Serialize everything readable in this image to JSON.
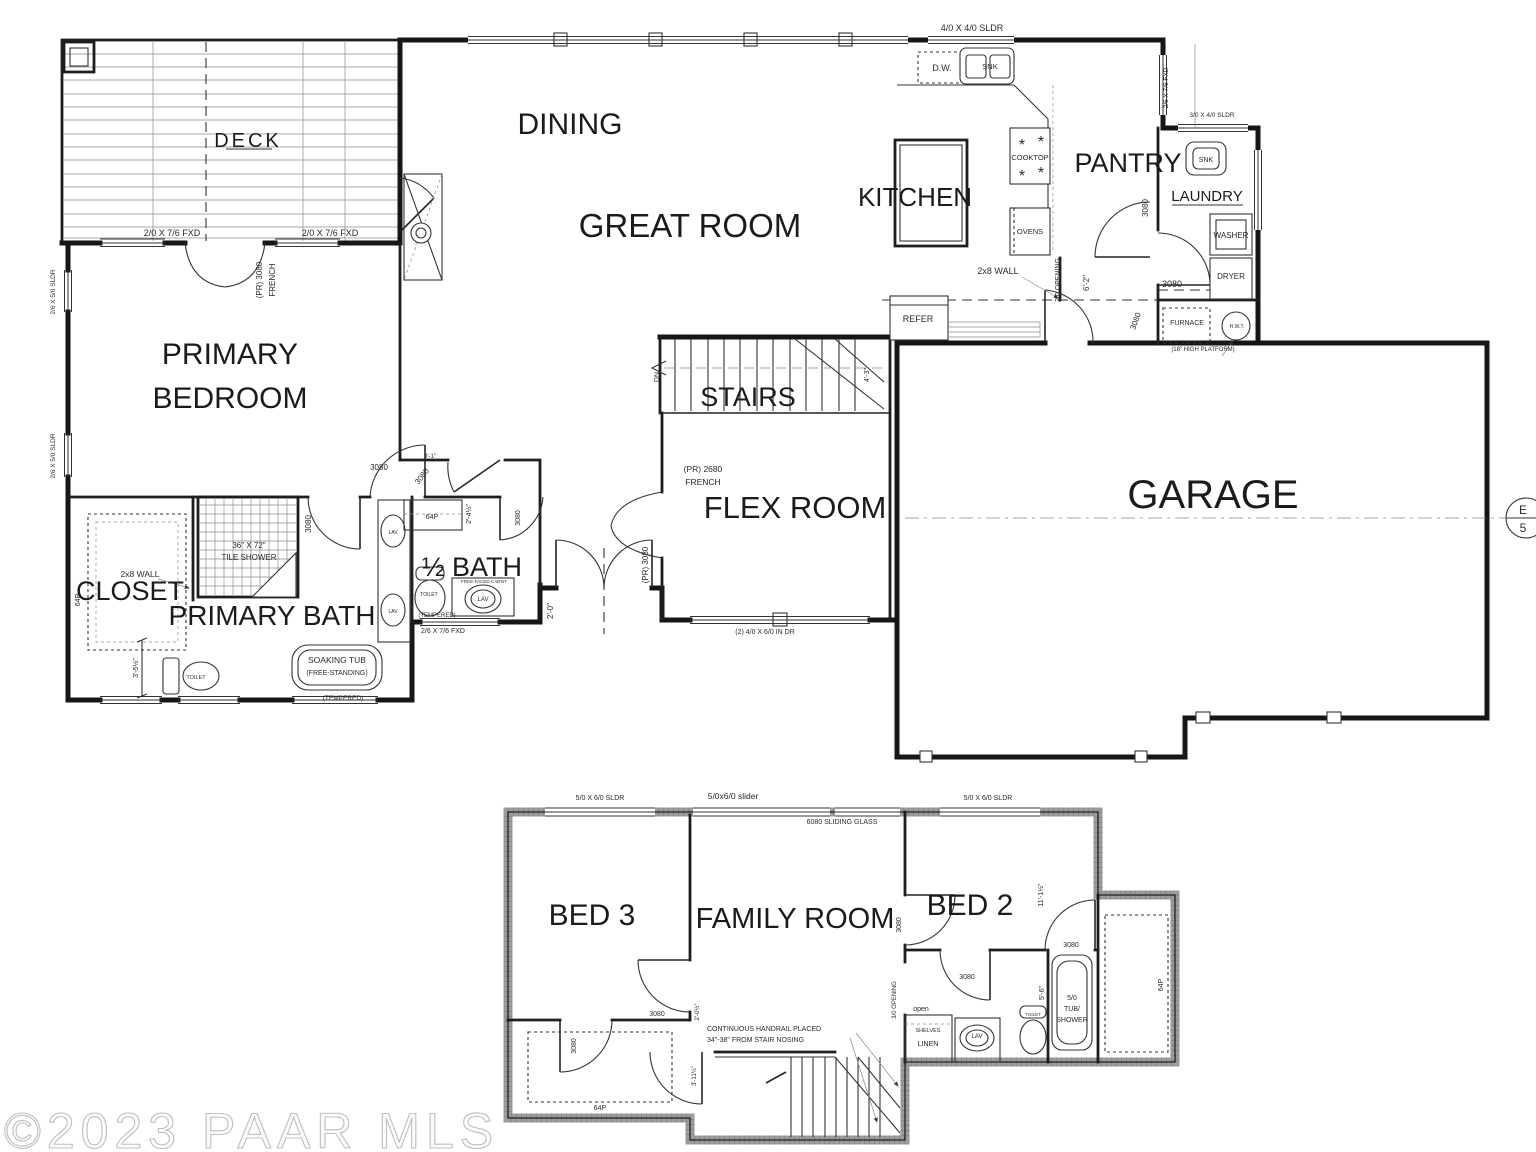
{
  "watermark": {
    "text": "©2023 PAAR MLS"
  },
  "colors": {
    "line": "#161616",
    "annotation": "#333333",
    "concrete": "#9b9b9b",
    "watermark": "#c8c8c8",
    "faded": "#8f8f8f"
  },
  "main_floor": {
    "rooms": {
      "deck": "DECK",
      "dining": "DINING",
      "great_room": "GREAT ROOM",
      "kitchen": "KITCHEN",
      "pantry": "PANTRY",
      "laundry": "LAUNDRY",
      "primary_line1": "PRIMARY",
      "primary_line2": "BEDROOM",
      "stairs": "STAIRS",
      "flex_room": "FLEX ROOM",
      "garage": "GARAGE",
      "closet": "CLOSET",
      "primary_bath": "PRIMARY BATH",
      "half_bath": "½ BATH"
    },
    "annotations": [
      {
        "t": "2/0 X 7/6 FXD",
        "x": 172,
        "y": 236,
        "s": 9
      },
      {
        "t": "2/0 X 7/6 FXD",
        "x": 330,
        "y": 236,
        "s": 9
      },
      {
        "t": "(PR) 3080",
        "x": 262,
        "y": 280,
        "s": 8,
        "r": -90
      },
      {
        "t": "FRENCH",
        "x": 275,
        "y": 280,
        "s": 8,
        "r": -90
      },
      {
        "t": "2/6 X 5/0 SLDR",
        "x": 55,
        "y": 292,
        "s": 6.5,
        "r": -90
      },
      {
        "t": "2/6 X 5/0 SLDR",
        "x": 55,
        "y": 456,
        "s": 6.5,
        "r": -90
      },
      {
        "t": "4/0 X 4/0 SLDR",
        "x": 972,
        "y": 31,
        "s": 9
      },
      {
        "t": "D.W.",
        "x": 942,
        "y": 71,
        "s": 9
      },
      {
        "t": "SNK",
        "x": 990,
        "y": 69,
        "s": 7.5
      },
      {
        "t": "COOKTOP",
        "x": 1030,
        "y": 160,
        "s": 7.5
      },
      {
        "t": "*",
        "x": 1022,
        "y": 150,
        "s": 16
      },
      {
        "t": "*",
        "x": 1041,
        "y": 147,
        "s": 16
      },
      {
        "t": "*",
        "x": 1022,
        "y": 181,
        "s": 16
      },
      {
        "t": "*",
        "x": 1041,
        "y": 178,
        "s": 16
      },
      {
        "t": "OVENS",
        "x": 1030,
        "y": 234,
        "s": 7.5
      },
      {
        "t": "2x8 WALL",
        "x": 998,
        "y": 274,
        "s": 9
      },
      {
        "t": "2/0 OPENING",
        "x": 1060,
        "y": 280,
        "s": 7,
        "r": -90
      },
      {
        "t": "6'-2\"",
        "x": 1089,
        "y": 283,
        "s": 8,
        "r": -90
      },
      {
        "t": "REFER",
        "x": 918,
        "y": 322,
        "s": 9
      },
      {
        "t": "3080",
        "x": 1138,
        "y": 322,
        "s": 8,
        "r": -70
      },
      {
        "t": "2/6 X 7/6 FXD",
        "x": 1168,
        "y": 88,
        "s": 6.5,
        "r": -90
      },
      {
        "t": "3/0 X 4/0 SLDR",
        "x": 1212,
        "y": 117,
        "s": 6.5
      },
      {
        "t": "SNK",
        "x": 1206,
        "y": 162,
        "s": 7
      },
      {
        "t": "3080",
        "x": 1148,
        "y": 208,
        "s": 8,
        "r": -90
      },
      {
        "t": "WASHER",
        "x": 1231,
        "y": 238,
        "s": 8
      },
      {
        "t": "DRYER",
        "x": 1231,
        "y": 279,
        "s": 8
      },
      {
        "t": "3080",
        "x": 1172,
        "y": 287,
        "s": 9
      },
      {
        "t": "FURNACE",
        "x": 1187,
        "y": 325,
        "s": 7
      },
      {
        "t": "H.W.T.",
        "x": 1237,
        "y": 328,
        "s": 5
      },
      {
        "t": "(18\" HIGH PLATFORM)",
        "x": 1203,
        "y": 351,
        "s": 6
      },
      {
        "t": "DN",
        "x": 659,
        "y": 377,
        "s": 7,
        "r": -90
      },
      {
        "t": "4'-3\"",
        "x": 869,
        "y": 375,
        "s": 7,
        "r": -90
      },
      {
        "t": "(PR) 2680",
        "x": 703,
        "y": 472,
        "s": 8.5
      },
      {
        "t": "FRENCH",
        "x": 703,
        "y": 485,
        "s": 8.5
      },
      {
        "t": "(PR) 3080",
        "x": 648,
        "y": 565,
        "s": 8,
        "r": -90
      },
      {
        "t": "2'-0\"",
        "x": 553,
        "y": 611,
        "s": 8,
        "r": -90
      },
      {
        "t": "(2) 4/0 X 6/0 IN DR",
        "x": 765,
        "y": 634,
        "s": 7
      },
      {
        "t": "36\" X 72\"",
        "x": 249,
        "y": 548,
        "s": 8
      },
      {
        "t": "TILE SHOWER",
        "x": 249,
        "y": 560,
        "s": 8
      },
      {
        "t": "2x8 WALL",
        "x": 140,
        "y": 577,
        "s": 8.5
      },
      {
        "t": "64P",
        "x": 80,
        "y": 600,
        "s": 7,
        "r": -90
      },
      {
        "t": "3'-5½\"",
        "x": 138,
        "y": 668,
        "s": 7,
        "r": -90
      },
      {
        "t": "TOILET",
        "x": 196,
        "y": 679,
        "s": 5.5
      },
      {
        "t": "SOAKING TUB",
        "x": 337,
        "y": 663,
        "s": 8.5
      },
      {
        "t": "(FREE-STANDING)",
        "x": 337,
        "y": 675,
        "s": 7
      },
      {
        "t": "(TEMPERED)",
        "x": 343,
        "y": 700,
        "s": 6.5
      },
      {
        "t": "3080",
        "x": 311,
        "y": 524,
        "s": 8,
        "r": -90
      },
      {
        "t": "3080",
        "x": 379,
        "y": 470,
        "s": 8
      },
      {
        "t": "3080",
        "x": 424,
        "y": 478,
        "s": 8,
        "r": -52
      },
      {
        "t": "3'-1\"",
        "x": 430,
        "y": 458,
        "s": 6
      },
      {
        "t": "LAV",
        "x": 393,
        "y": 534,
        "s": 5
      },
      {
        "t": "LAV",
        "x": 393,
        "y": 613,
        "s": 5
      },
      {
        "t": "64P",
        "x": 432,
        "y": 519,
        "s": 7
      },
      {
        "t": "2'-4½\"",
        "x": 471,
        "y": 514,
        "s": 7,
        "r": -90
      },
      {
        "t": "3080",
        "x": 520,
        "y": 518,
        "s": 7,
        "r": -90
      },
      {
        "t": "FREE-FACED CAB'NT",
        "x": 484,
        "y": 583,
        "s": 4.5
      },
      {
        "t": "LAV",
        "x": 483,
        "y": 601,
        "s": 6
      },
      {
        "t": "TOILET",
        "x": 429,
        "y": 596,
        "s": 5
      },
      {
        "t": "(TEMPERED)",
        "x": 437,
        "y": 617,
        "s": 6
      },
      {
        "t": "2/6 X 7/6 FXD",
        "x": 443,
        "y": 633,
        "s": 7
      },
      {
        "t": "E",
        "x": 1523,
        "y": 514,
        "s": 12
      },
      {
        "t": "5",
        "x": 1523,
        "y": 532,
        "s": 12
      }
    ]
  },
  "lower_floor": {
    "rooms": {
      "bed3": "BED 3",
      "family_room": "FAMILY ROOM",
      "bed2": "BED 2"
    },
    "annotations": [
      {
        "t": "5/0 X 6/0 SLDR",
        "x": 600,
        "y": 800,
        "s": 7
      },
      {
        "t": "5/0x6/0 slider",
        "x": 733,
        "y": 799,
        "s": 8.5,
        "f": "m",
        "c": "#8f8f8f"
      },
      {
        "t": "6080 SLIDING GLASS",
        "x": 842,
        "y": 824,
        "s": 7
      },
      {
        "t": "5/0 X 6/0 SLDR",
        "x": 988,
        "y": 800,
        "s": 7
      },
      {
        "t": "11'-1½\"",
        "x": 1043,
        "y": 895,
        "s": 7,
        "r": -90
      },
      {
        "t": "3080",
        "x": 657,
        "y": 1016,
        "s": 7
      },
      {
        "t": "3080",
        "x": 576,
        "y": 1046,
        "s": 7,
        "r": -90
      },
      {
        "t": "64P",
        "x": 600,
        "y": 1110,
        "s": 7
      },
      {
        "t": "CONTINUOUS HANDRAIL PLACED",
        "x": 707,
        "y": 1031,
        "s": 7,
        "a": "start"
      },
      {
        "t": "34\"-38\" FROM STAIR NOSING",
        "x": 707,
        "y": 1042,
        "s": 7,
        "a": "start"
      },
      {
        "t": "3/0 OPENING",
        "x": 896,
        "y": 1000,
        "s": 6,
        "r": -90
      },
      {
        "t": "3080",
        "x": 901,
        "y": 925,
        "s": 7,
        "r": -90
      },
      {
        "t": "3080",
        "x": 967,
        "y": 979,
        "s": 7
      },
      {
        "t": "open",
        "x": 921,
        "y": 1011,
        "s": 7,
        "c": "#b0b0b0"
      },
      {
        "t": "SHELVES",
        "x": 928,
        "y": 1032,
        "s": 5.5
      },
      {
        "t": "LINEN",
        "x": 928,
        "y": 1046,
        "s": 7
      },
      {
        "t": "LAV",
        "x": 977,
        "y": 1038,
        "s": 6
      },
      {
        "t": "TOILET",
        "x": 1033,
        "y": 1016,
        "s": 4.5
      },
      {
        "t": "5/0",
        "x": 1072,
        "y": 1000,
        "s": 7
      },
      {
        "t": "TUB/",
        "x": 1072,
        "y": 1011,
        "s": 7
      },
      {
        "t": "SHOWER",
        "x": 1072,
        "y": 1022,
        "s": 7
      },
      {
        "t": "5'-6\"",
        "x": 1044,
        "y": 993,
        "s": 7,
        "r": -90
      },
      {
        "t": "3080",
        "x": 1071,
        "y": 947,
        "s": 7
      },
      {
        "t": "64P",
        "x": 1163,
        "y": 985,
        "s": 7,
        "r": -90
      },
      {
        "t": "2'-0½\"",
        "x": 699,
        "y": 1012,
        "s": 6,
        "r": -90
      },
      {
        "t": "3'-11½\"",
        "x": 696,
        "y": 1076,
        "s": 6,
        "r": -90
      }
    ]
  }
}
